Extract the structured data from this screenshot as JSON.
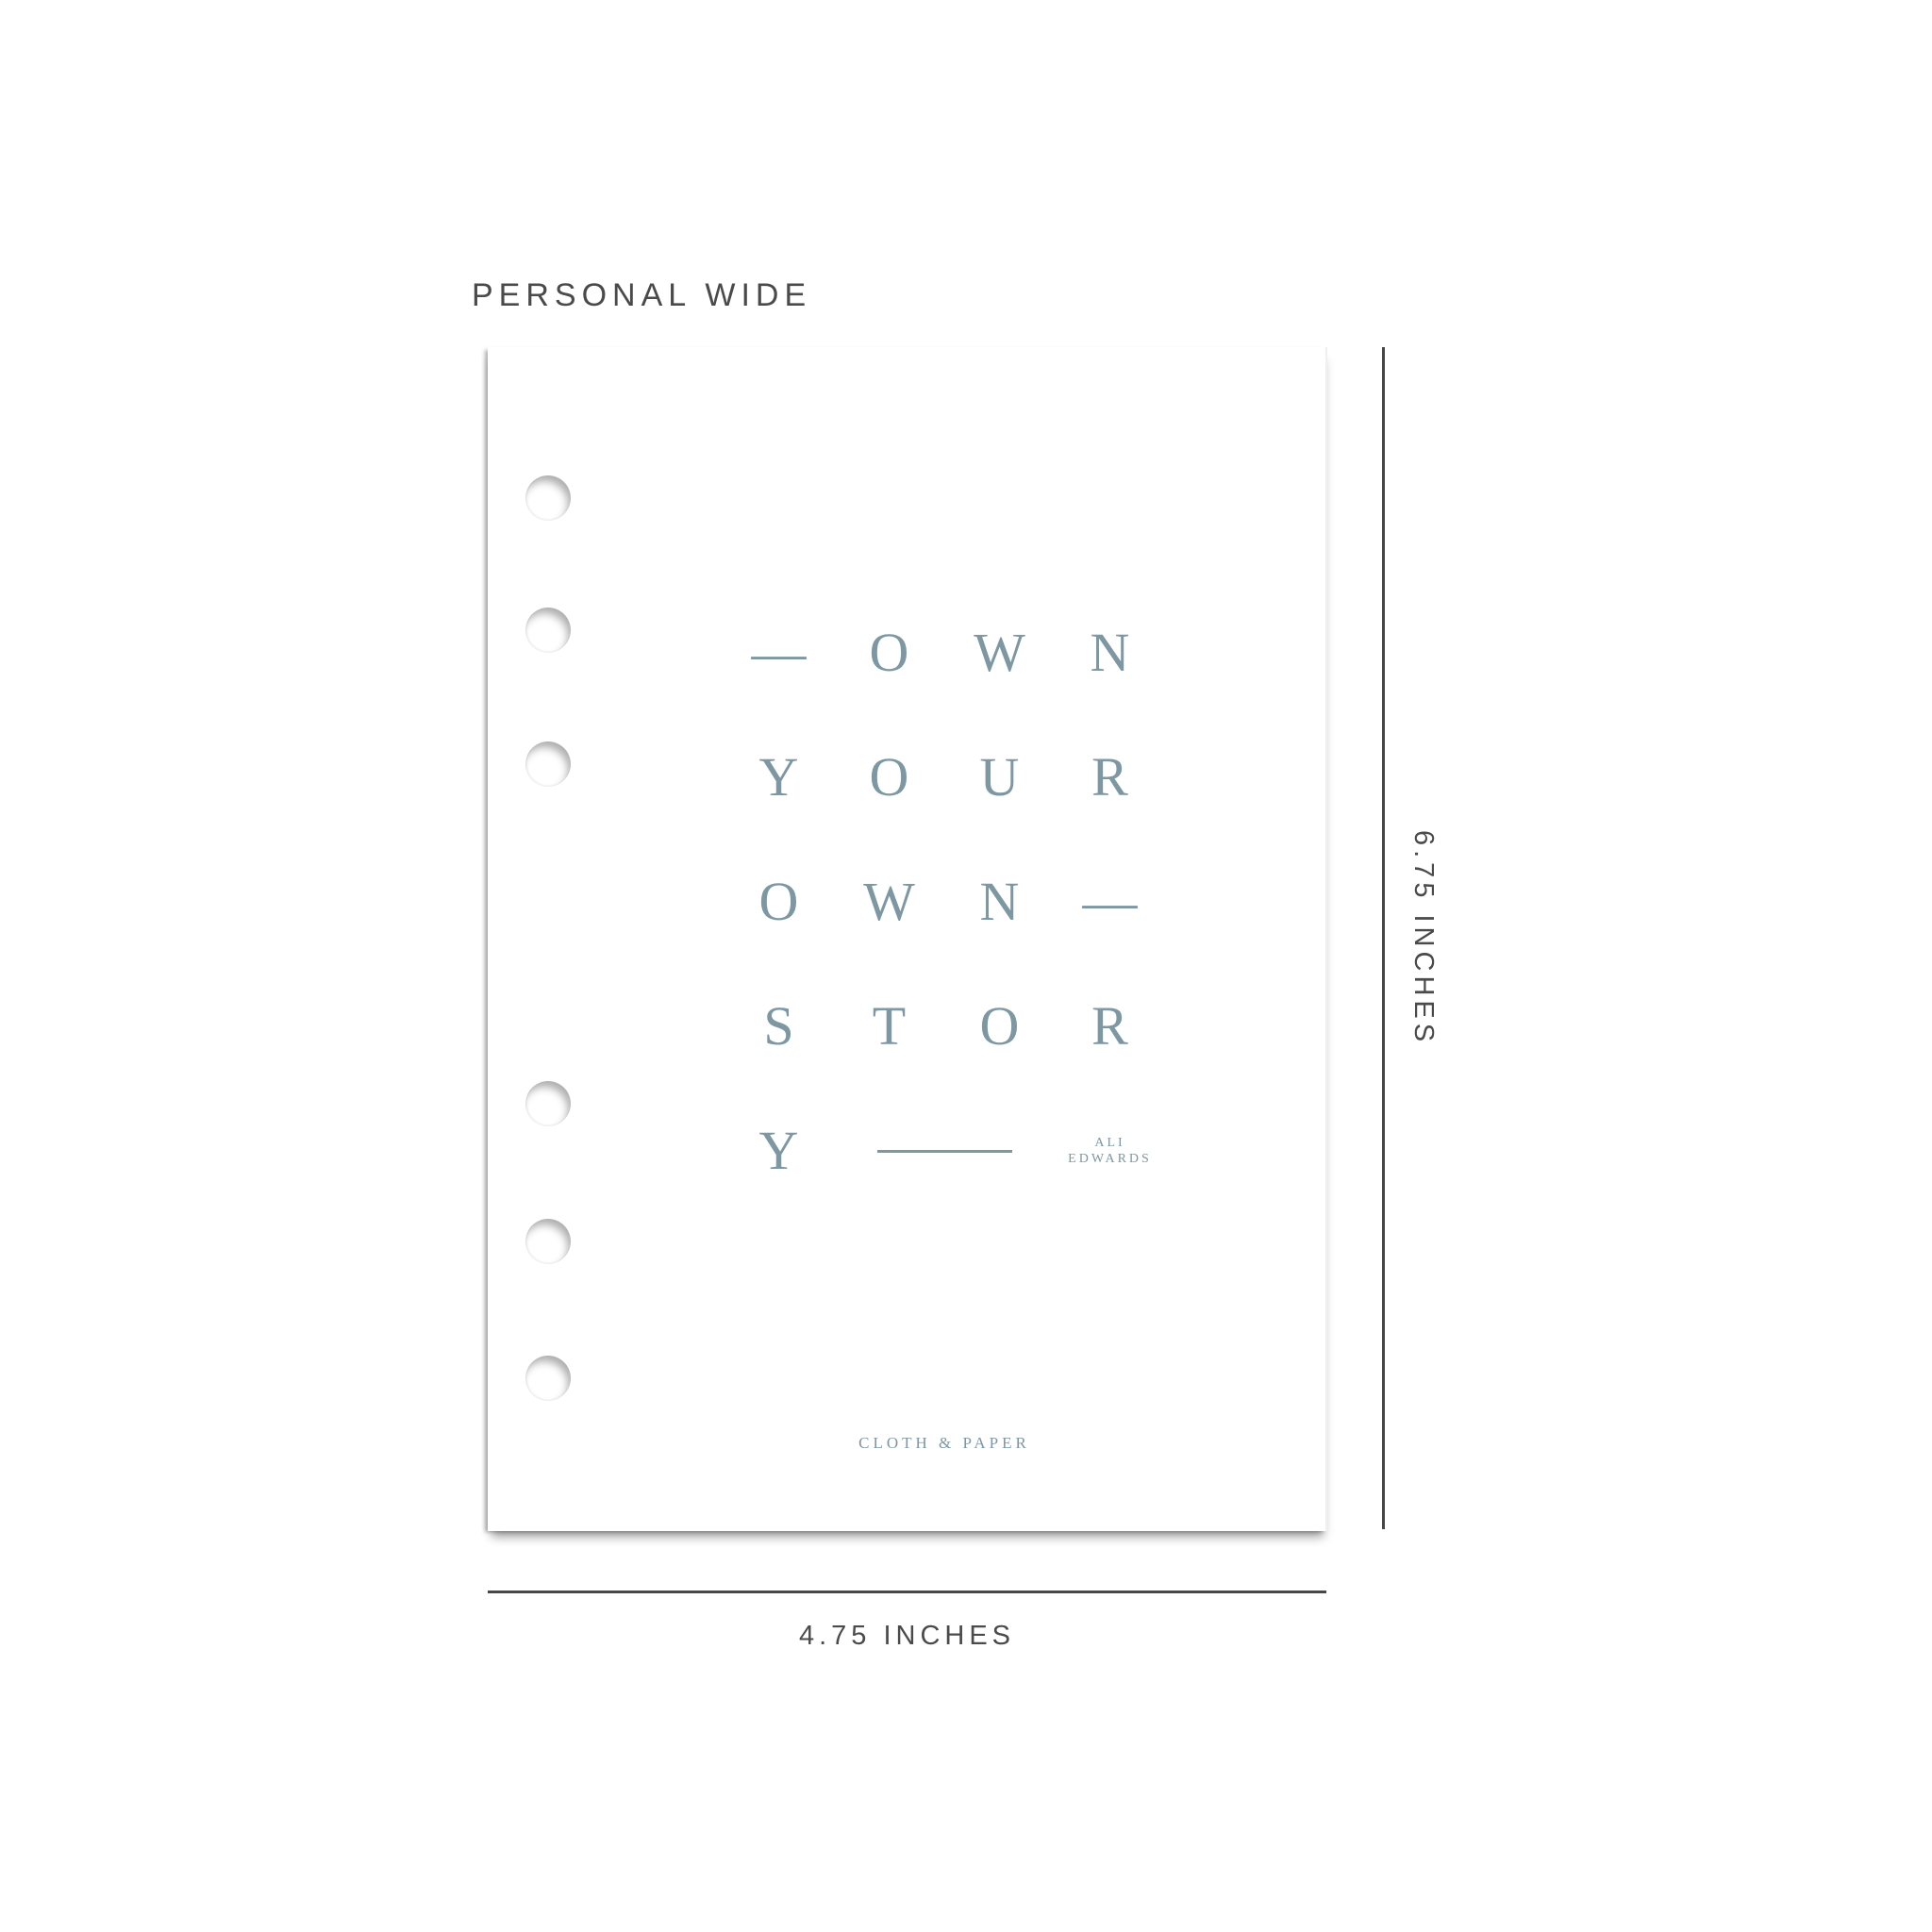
{
  "size_label": "PERSONAL WIDE",
  "page": {
    "quote": {
      "rows": [
        [
          "—",
          "O",
          "W",
          "N"
        ],
        [
          "Y",
          "O",
          "U",
          "R"
        ],
        [
          "O",
          "W",
          "N",
          "—"
        ],
        [
          "S",
          "T",
          "O",
          "R"
        ]
      ],
      "last_row_letter": "Y",
      "attribution": [
        "ALI",
        "EDWARDS"
      ]
    },
    "brand": "CLOTH & PAPER"
  },
  "dimensions": {
    "height_label": "6.75 INCHES",
    "width_label": "4.75 INCHES"
  },
  "colors": {
    "quote_blue": "#7d97a3",
    "annotation_gray": "#4a4a4a"
  }
}
